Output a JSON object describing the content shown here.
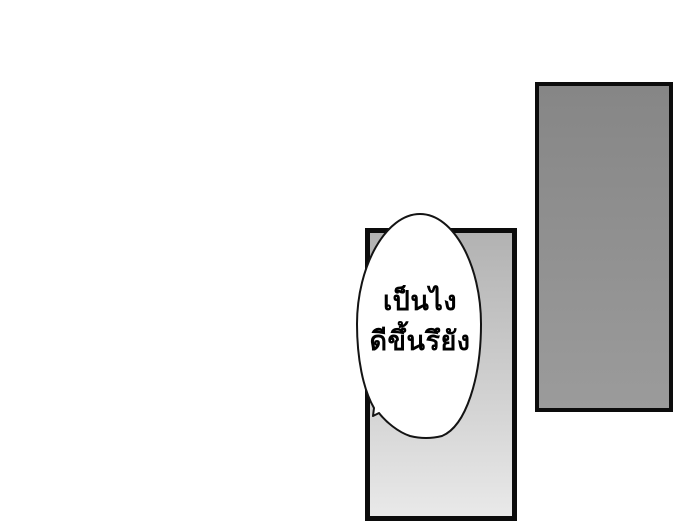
{
  "page": {
    "background_color": "#ffffff"
  },
  "panels": {
    "right": {
      "fill_top": "#868686",
      "fill_bottom": "#9b9b9b",
      "border_color": "#0c0c0c"
    },
    "center": {
      "fill_top": "#b2b2b2",
      "fill_bottom": "#e9e9e9",
      "border_color": "#0c0c0c"
    }
  },
  "speech_bubble": {
    "fill": "#ffffff",
    "outline": "#141414",
    "text_color": "#000000",
    "lines": [
      "เป็นไง",
      "ดีขึ้นรึยัง"
    ]
  }
}
